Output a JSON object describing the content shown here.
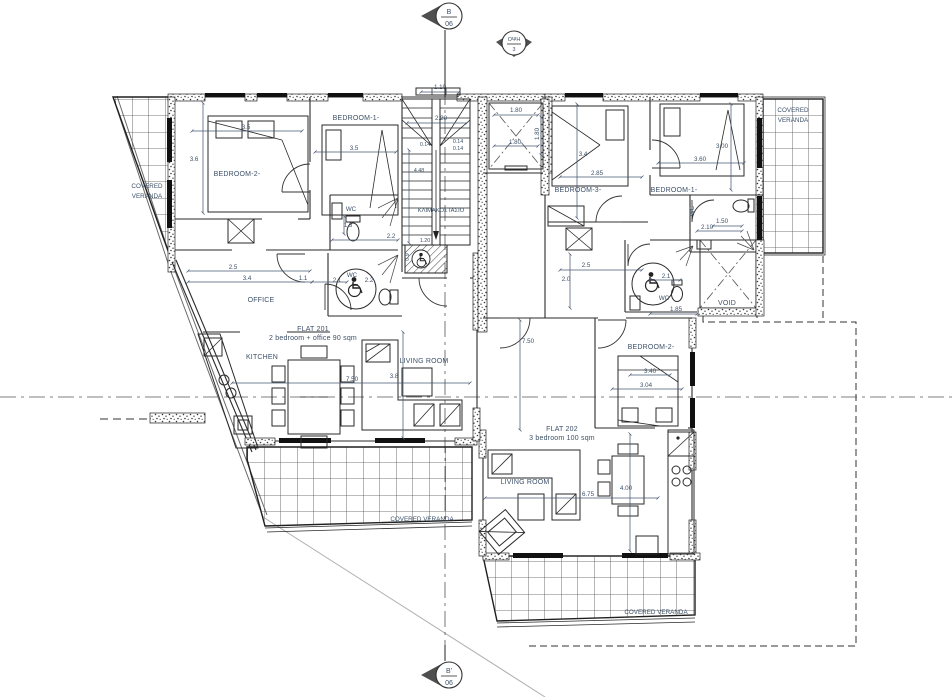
{
  "colors": {
    "ink": "#1f1f1f",
    "annotation": "#3c5068",
    "boundary": "#6b6b6b"
  },
  "markers": {
    "section_top": {
      "code": "B",
      "sheet": "06"
    },
    "elevation": {
      "code": "ΟΨΗ",
      "sheet": "3"
    },
    "section_bottom": {
      "code": "B'",
      "sheet": "06"
    }
  },
  "verandas": {
    "line1": "COVERED",
    "line2": "VERANDA",
    "full": "COVERED VERANDA"
  },
  "core": {
    "stair_label": "ΚΛΙΜΑΚΟΣΤΑΣΙΟ",
    "dims": {
      "entry": "1.10",
      "flight_w": "2.20",
      "riser1": "0.14",
      "riser2": "0.14",
      "riser3": "0.14",
      "run": "4.48",
      "lift_a": "1.80",
      "lift_b": "1.80",
      "lift_c": "1.80",
      "pit_a": "1.20",
      "pit_b": "0.9"
    }
  },
  "flat201": {
    "name": "FLAT 201",
    "desc": "2 bedroom + office 90 sqm",
    "rooms": {
      "bedroom2": "BEDROOM-2-",
      "bedroom1": "BEDROOM-1-",
      "wc_small": "WC",
      "wc_access": "WC",
      "office": "OFFICE",
      "kitchen": "KITCHEN",
      "living": "LIVING ROOM"
    },
    "dims": {
      "bed2_w": "3.5",
      "bed2_h": "3.6",
      "bed1_w": "3.5",
      "wc_small_d": "1.3",
      "wc_small_w": "2.2",
      "wc_access_a": "2.1",
      "wc_access_b": "2.2",
      "hall_a": "2.5",
      "hall_b": "3.4",
      "hall_c": "1.1",
      "living_w": "7.50",
      "living_h": "3.8"
    }
  },
  "flat202": {
    "name": "FLAT 202",
    "desc": "3 bedroom 100 sqm",
    "rooms": {
      "bedroom3": "BEDROOM-3-",
      "bedroom1": "BEDROOM-1-",
      "bedroom2": "BEDROOM-2-",
      "wc_top": "WC",
      "wc_access": "WC",
      "living": "LIVING ROOM",
      "void": "VOID"
    },
    "dims": {
      "bed3_h": "3.4",
      "bed3_w": "2.85",
      "bed1_h": "3.00",
      "bed1_w": "3.60",
      "wc_top_h": "1.50",
      "wc_top_w": "2.10",
      "hall_a": "2.5",
      "hall_b": "2.0",
      "wc_access_a": "2.1",
      "wc_access_b": "1.85",
      "bed2_a": "3.40",
      "bed2_b": "3.04",
      "entry_w": "7.50",
      "living_w": "6.75",
      "kitchen_w": "4.00"
    }
  }
}
